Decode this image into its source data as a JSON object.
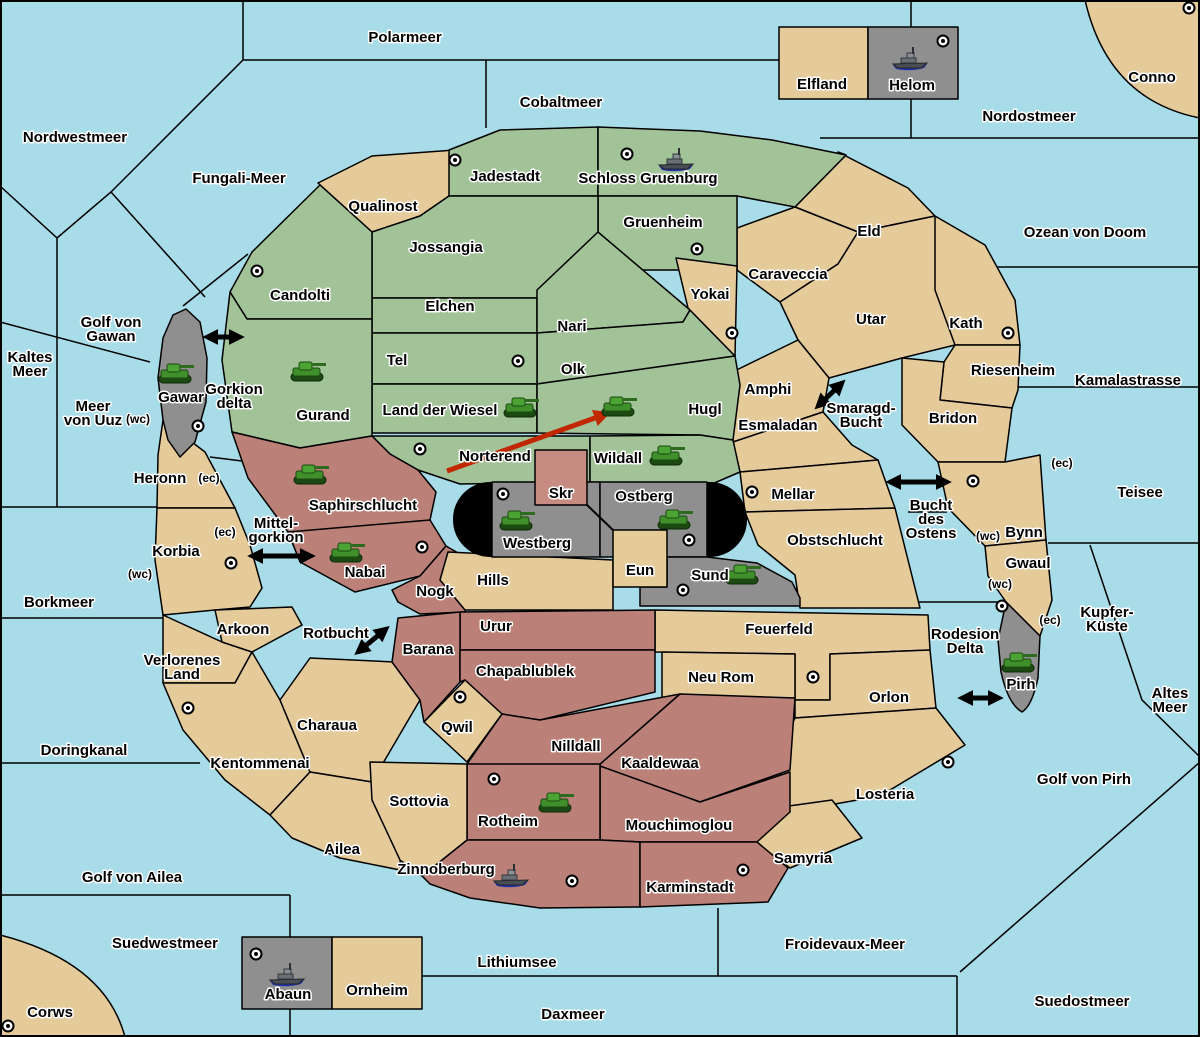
{
  "map": {
    "colors": {
      "sea": "#a8dce8",
      "tan": "#e5ca9a",
      "green": "#a2c298",
      "maroon": "#bb8078",
      "gray": "#8f8f8f",
      "pink": "#c68c82",
      "wall": "#000000",
      "move_arrow": "#c22800",
      "tank": "#3f8f2a",
      "ship_hull": "#4a4f55"
    },
    "sea_labels": [
      {
        "id": "polarmeer",
        "lines": [
          "Polarmeer"
        ],
        "x": 405,
        "y": 38
      },
      {
        "id": "cobaltmeer",
        "lines": [
          "Cobaltmeer"
        ],
        "x": 561,
        "y": 103
      },
      {
        "id": "nordostmeer",
        "lines": [
          "Nordostmeer"
        ],
        "x": 1029,
        "y": 117
      },
      {
        "id": "nordwestmeer",
        "lines": [
          "Nordwestmeer"
        ],
        "x": 75,
        "y": 138
      },
      {
        "id": "fungali-meer",
        "lines": [
          "Fungali-Meer"
        ],
        "x": 239,
        "y": 179
      },
      {
        "id": "ozean-von-doom",
        "lines": [
          "Ozean von Doom"
        ],
        "x": 1085,
        "y": 233
      },
      {
        "id": "kaltes-meer",
        "lines": [
          "Kaltes",
          "Meer"
        ],
        "x": 30,
        "y": 365
      },
      {
        "id": "golf-von-gawan",
        "lines": [
          "Golf von",
          "Gawan"
        ],
        "x": 111,
        "y": 330
      },
      {
        "id": "meer-von-uuz",
        "lines": [
          "Meer",
          "von Uuz"
        ],
        "x": 93,
        "y": 414
      },
      {
        "id": "gorkion-delta",
        "lines": [
          "Gorkion",
          "delta"
        ],
        "x": 234,
        "y": 397
      },
      {
        "id": "mittel-gorkion",
        "lines": [
          "Mittel-",
          "gorkion"
        ],
        "x": 276,
        "y": 531
      },
      {
        "id": "borkmeer",
        "lines": [
          "Borkmeer"
        ],
        "x": 59,
        "y": 603
      },
      {
        "id": "doringkanal",
        "lines": [
          "Doringkanal"
        ],
        "x": 84,
        "y": 751
      },
      {
        "id": "golf-von-ailea",
        "lines": [
          "Golf von Ailea"
        ],
        "x": 132,
        "y": 878
      },
      {
        "id": "suedwestmeer",
        "lines": [
          "Suedwestmeer"
        ],
        "x": 165,
        "y": 944
      },
      {
        "id": "lithiumsee",
        "lines": [
          "Lithiumsee"
        ],
        "x": 517,
        "y": 963
      },
      {
        "id": "daxmeer",
        "lines": [
          "Daxmeer"
        ],
        "x": 573,
        "y": 1015
      },
      {
        "id": "froidevaux-meer",
        "lines": [
          "Froidevaux-Meer"
        ],
        "x": 845,
        "y": 945
      },
      {
        "id": "suedostmeer",
        "lines": [
          "Suedostmeer"
        ],
        "x": 1082,
        "y": 1002
      },
      {
        "id": "golf-von-pirh",
        "lines": [
          "Golf von Pirh"
        ],
        "x": 1084,
        "y": 780
      },
      {
        "id": "altes-meer",
        "lines": [
          "Altes",
          "Meer"
        ],
        "x": 1170,
        "y": 701
      },
      {
        "id": "kupfer-kueste",
        "lines": [
          "Kupfer-",
          "Küste"
        ],
        "x": 1107,
        "y": 620
      },
      {
        "id": "teisee",
        "lines": [
          "Teisee"
        ],
        "x": 1140,
        "y": 493
      },
      {
        "id": "kamalastrasse",
        "lines": [
          "Kamalastrasse"
        ],
        "x": 1128,
        "y": 381
      },
      {
        "id": "smaragd-bucht",
        "lines": [
          "Smaragd-",
          "Bucht"
        ],
        "x": 861,
        "y": 416
      },
      {
        "id": "bucht-des-ostens",
        "lines": [
          "Bucht",
          "des",
          "Ostens"
        ],
        "x": 931,
        "y": 520
      },
      {
        "id": "rotbucht",
        "lines": [
          "Rotbucht"
        ],
        "x": 336,
        "y": 634
      },
      {
        "id": "rodesion-delta",
        "lines": [
          "Rodesion",
          "Delta"
        ],
        "x": 965,
        "y": 642
      }
    ],
    "territories": [
      {
        "id": "qualinost",
        "name": "Qualinost",
        "color": "tan",
        "lx": 383,
        "ly": 207
      },
      {
        "id": "jadestadt",
        "name": "Jadestadt",
        "color": "green",
        "lx": 505,
        "ly": 177,
        "dot": [
          455,
          160
        ]
      },
      {
        "id": "schloss_gruenburg",
        "name": "Schloss Gruenburg",
        "color": "green",
        "lx": 648,
        "ly": 179,
        "dot": [
          627,
          154
        ],
        "unit": "ship",
        "ux": 676,
        "uy": 160
      },
      {
        "id": "gruenheim",
        "name": "Gruenheim",
        "color": "green",
        "lx": 663,
        "ly": 223,
        "dot": [
          697,
          249
        ]
      },
      {
        "id": "jossangia",
        "name": "Jossangia",
        "color": "green",
        "lx": 446,
        "ly": 248
      },
      {
        "id": "elchen",
        "name": "Elchen",
        "color": "green",
        "lx": 450,
        "ly": 307
      },
      {
        "id": "nari",
        "name": "Nari",
        "color": "green",
        "lx": 572,
        "ly": 327
      },
      {
        "id": "olk",
        "name": "Olk",
        "color": "green",
        "lx": 573,
        "ly": 370
      },
      {
        "id": "tel",
        "name": "Tel",
        "color": "green",
        "lx": 397,
        "ly": 361,
        "dot": [
          518,
          361
        ]
      },
      {
        "id": "land_der_wiesel",
        "name": "Land der Wiesel",
        "color": "green",
        "lx": 440,
        "ly": 411,
        "unit": "tank",
        "ux": 520,
        "uy": 408
      },
      {
        "id": "hugl",
        "name": "Hugl",
        "color": "green",
        "lx": 705,
        "ly": 410,
        "unit": "tank",
        "ux": 618,
        "uy": 407
      },
      {
        "id": "norterend",
        "name": "Norterend",
        "color": "green",
        "lx": 495,
        "ly": 457,
        "dot": [
          420,
          449
        ]
      },
      {
        "id": "wildall",
        "name": "Wildall",
        "color": "green",
        "lx": 618,
        "ly": 459,
        "unit": "tank",
        "ux": 666,
        "uy": 456
      },
      {
        "id": "candolti",
        "name": "Candolti",
        "color": "green",
        "lx": 300,
        "ly": 296,
        "dot": [
          257,
          271
        ]
      },
      {
        "id": "gurand",
        "name": "Gurand",
        "color": "green",
        "lx": 323,
        "ly": 416,
        "unit": "tank",
        "ux": 307,
        "uy": 372
      },
      {
        "id": "yokai",
        "name": "Yokai",
        "color": "tan",
        "lx": 710,
        "ly": 295,
        "dot": [
          732,
          333
        ]
      },
      {
        "id": "caraveccia",
        "name": "Caraveccia",
        "color": "tan",
        "lx": 788,
        "ly": 275
      },
      {
        "id": "eld",
        "name": "Eld",
        "color": "tan",
        "lx": 869,
        "ly": 232
      },
      {
        "id": "utar",
        "name": "Utar",
        "color": "tan",
        "lx": 871,
        "ly": 320
      },
      {
        "id": "kath",
        "name": "Kath",
        "color": "tan",
        "lx": 966,
        "ly": 324,
        "dot": [
          1008,
          333
        ]
      },
      {
        "id": "riesenheim",
        "name": "Riesenheim",
        "color": "tan",
        "lx": 1013,
        "ly": 371
      },
      {
        "id": "bridon",
        "name": "Bridon",
        "color": "tan",
        "lx": 953,
        "ly": 419
      },
      {
        "id": "bynn",
        "name": "Bynn",
        "color": "tan",
        "lx": 1024,
        "ly": 533,
        "dot": [
          973,
          481
        ]
      },
      {
        "id": "gwaul",
        "name": "Gwaul",
        "color": "tan",
        "lx": 1028,
        "ly": 564
      },
      {
        "id": "pirh",
        "name": "Pirh",
        "color": "gray",
        "lx": 1021,
        "ly": 685,
        "dot": [
          1002,
          606
        ],
        "unit": "tank",
        "ux": 1018,
        "uy": 663
      },
      {
        "id": "amphi",
        "name": "Amphi",
        "color": "tan",
        "lx": 768,
        "ly": 390
      },
      {
        "id": "esmaladan",
        "name": "Esmaladan",
        "color": "tan",
        "lx": 778,
        "ly": 426
      },
      {
        "id": "mellar",
        "name": "Mellar",
        "color": "tan",
        "lx": 793,
        "ly": 495,
        "dot": [
          752,
          492
        ]
      },
      {
        "id": "obstschlucht",
        "name": "Obstschlucht",
        "color": "tan",
        "lx": 835,
        "ly": 541
      },
      {
        "id": "feuerfeld",
        "name": "Feuerfeld",
        "color": "tan",
        "lx": 779,
        "ly": 630,
        "dot": [
          813,
          677
        ]
      },
      {
        "id": "neu_rom",
        "name": "Neu Rom",
        "color": "tan",
        "lx": 721,
        "ly": 678
      },
      {
        "id": "orlon",
        "name": "Orlon",
        "color": "tan",
        "lx": 889,
        "ly": 698
      },
      {
        "id": "losteria",
        "name": "Losteria",
        "color": "tan",
        "lx": 885,
        "ly": 795,
        "dot": [
          948,
          762
        ]
      },
      {
        "id": "samyria",
        "name": "Samyria",
        "color": "tan",
        "lx": 803,
        "ly": 859
      },
      {
        "id": "westberg",
        "name": "Westberg",
        "color": "gray",
        "lx": 537,
        "ly": 544,
        "dot": [
          503,
          494
        ],
        "unit": "tank",
        "ux": 516,
        "uy": 521
      },
      {
        "id": "ostberg",
        "name": "Ostberg",
        "color": "gray",
        "lx": 644,
        "ly": 497,
        "dot": [
          689,
          540
        ],
        "unit": "tank",
        "ux": 674,
        "uy": 520
      },
      {
        "id": "sund",
        "name": "Sund",
        "color": "gray",
        "lx": 710,
        "ly": 576,
        "dot": [
          683,
          590
        ],
        "unit": "tank",
        "ux": 742,
        "uy": 575
      },
      {
        "id": "skr",
        "name": "Skr",
        "color": "pink",
        "lx": 561,
        "ly": 494
      },
      {
        "id": "eun",
        "name": "Eun",
        "color": "tan",
        "lx": 640,
        "ly": 571
      },
      {
        "id": "hills",
        "name": "Hills",
        "color": "tan",
        "lx": 493,
        "ly": 581
      },
      {
        "id": "saphirschlucht",
        "name": "Saphirschlucht",
        "color": "maroon",
        "lx": 363,
        "ly": 506,
        "unit": "tank",
        "ux": 310,
        "uy": 475
      },
      {
        "id": "nabai",
        "name": "Nabai",
        "color": "maroon",
        "lx": 365,
        "ly": 573,
        "dot": [
          422,
          547
        ],
        "unit": "tank",
        "ux": 346,
        "uy": 553
      },
      {
        "id": "nogk",
        "name": "Nogk",
        "color": "maroon",
        "lx": 435,
        "ly": 592
      },
      {
        "id": "urur",
        "name": "Urur",
        "color": "maroon",
        "lx": 496,
        "ly": 627
      },
      {
        "id": "barana",
        "name": "Barana",
        "color": "maroon",
        "lx": 428,
        "ly": 650
      },
      {
        "id": "chapablublek",
        "name": "Chapablublek",
        "color": "maroon",
        "lx": 525,
        "ly": 672
      },
      {
        "id": "nilldall",
        "name": "Nilldall",
        "color": "maroon",
        "lx": 576,
        "ly": 747
      },
      {
        "id": "kaaldewaa",
        "name": "Kaaldewaa",
        "color": "maroon",
        "lx": 660,
        "ly": 764
      },
      {
        "id": "mouchimoglou",
        "name": "Mouchimoglou",
        "color": "maroon",
        "lx": 679,
        "ly": 826
      },
      {
        "id": "rotheim",
        "name": "Rotheim",
        "color": "maroon",
        "lx": 508,
        "ly": 822,
        "dot": [
          494,
          779
        ],
        "unit": "tank",
        "ux": 555,
        "uy": 803
      },
      {
        "id": "zinnoberburg",
        "name": "Zinnoberburg",
        "color": "maroon",
        "lx": 446,
        "ly": 870,
        "dot": [
          572,
          881
        ],
        "unit": "ship",
        "ux": 511,
        "uy": 876
      },
      {
        "id": "karminstadt",
        "name": "Karminstadt",
        "color": "maroon",
        "lx": 690,
        "ly": 888,
        "dot": [
          743,
          870
        ]
      },
      {
        "id": "qwil",
        "name": "Qwil",
        "color": "tan",
        "lx": 457,
        "ly": 728,
        "dot": [
          460,
          697
        ]
      },
      {
        "id": "sottovia",
        "name": "Sottovia",
        "color": "tan",
        "lx": 419,
        "ly": 802
      },
      {
        "id": "charaua",
        "name": "Charaua",
        "color": "tan",
        "lx": 327,
        "ly": 726
      },
      {
        "id": "kentommenai",
        "name": "Kentommenai",
        "color": "tan",
        "lx": 260,
        "ly": 764,
        "dot": [
          188,
          708
        ]
      },
      {
        "id": "arkoon",
        "name": "Arkoon",
        "color": "tan",
        "lx": 243,
        "ly": 630
      },
      {
        "id": "verlorenes_land",
        "name": "Verlorenes Land",
        "color": "tan",
        "lx": 182,
        "ly": 668,
        "lines": [
          "Verlorenes",
          "Land"
        ]
      },
      {
        "id": "korbia",
        "name": "Korbia",
        "color": "tan",
        "lx": 176,
        "ly": 552,
        "dot": [
          231,
          563
        ]
      },
      {
        "id": "heronn",
        "name": "Heronn",
        "color": "tan",
        "lx": 160,
        "ly": 479
      },
      {
        "id": "ailea",
        "name": "Ailea",
        "color": "tan",
        "lx": 342,
        "ly": 850
      },
      {
        "id": "gawar",
        "name": "Gawar",
        "color": "gray",
        "lx": 181,
        "ly": 398,
        "dot": [
          198,
          426
        ],
        "unit": "tank",
        "ux": 175,
        "uy": 374
      },
      {
        "id": "conno",
        "name": "Conno",
        "color": "tan",
        "lx": 1152,
        "ly": 78,
        "dot": [
          1189,
          8
        ]
      },
      {
        "id": "corws",
        "name": "Corws",
        "color": "tan",
        "lx": 50,
        "ly": 1013,
        "dot": [
          8,
          1026
        ]
      },
      {
        "id": "elfland",
        "name": "Elfland",
        "color": "tan",
        "lx": 822,
        "ly": 85
      },
      {
        "id": "helom",
        "name": "Helom",
        "color": "gray",
        "lx": 912,
        "ly": 86,
        "dot": [
          943,
          41
        ],
        "unit": "ship",
        "ux": 910,
        "uy": 59
      },
      {
        "id": "abaun",
        "name": "Abaun",
        "color": "gray",
        "lx": 288,
        "ly": 995,
        "dot": [
          256,
          954
        ],
        "unit": "ship",
        "ux": 287,
        "uy": 975
      },
      {
        "id": "ornheim",
        "name": "Ornheim",
        "color": "tan",
        "lx": 377,
        "ly": 991
      }
    ],
    "coast_labels": [
      {
        "text": "(wc)",
        "x": 138,
        "y": 420
      },
      {
        "text": "(ec)",
        "x": 209,
        "y": 479
      },
      {
        "text": "(ec)",
        "x": 225,
        "y": 533
      },
      {
        "text": "(wc)",
        "x": 140,
        "y": 575
      },
      {
        "text": "(ec)",
        "x": 1062,
        "y": 464
      },
      {
        "text": "(wc)",
        "x": 988,
        "y": 537
      },
      {
        "text": "(wc)",
        "x": 1000,
        "y": 585
      },
      {
        "text": "(ec)",
        "x": 1050,
        "y": 621
      }
    ],
    "adjacency_arrows": [
      {
        "id": "gorkion-delta-arrow",
        "x1": 207,
        "y1": 337,
        "x2": 240,
        "y2": 337
      },
      {
        "id": "mittel-gorkion-arrow",
        "x1": 252,
        "y1": 556,
        "x2": 311,
        "y2": 556
      },
      {
        "id": "smaragd-bucht-arrow",
        "x1": 818,
        "y1": 406,
        "x2": 842,
        "y2": 383
      },
      {
        "id": "bucht-des-ostens-arrow",
        "x1": 890,
        "y1": 482,
        "x2": 947,
        "y2": 482
      },
      {
        "id": "rotbucht-arrow",
        "x1": 358,
        "y1": 652,
        "x2": 386,
        "y2": 629
      },
      {
        "id": "rodesion-delta-arrow",
        "x1": 962,
        "y1": 698,
        "x2": 999,
        "y2": 698
      }
    ],
    "move_arrow": {
      "from_territory": "Norterend",
      "to_territory": "Hugl",
      "x1": 447,
      "y1": 471,
      "x2": 606,
      "y2": 414
    }
  }
}
